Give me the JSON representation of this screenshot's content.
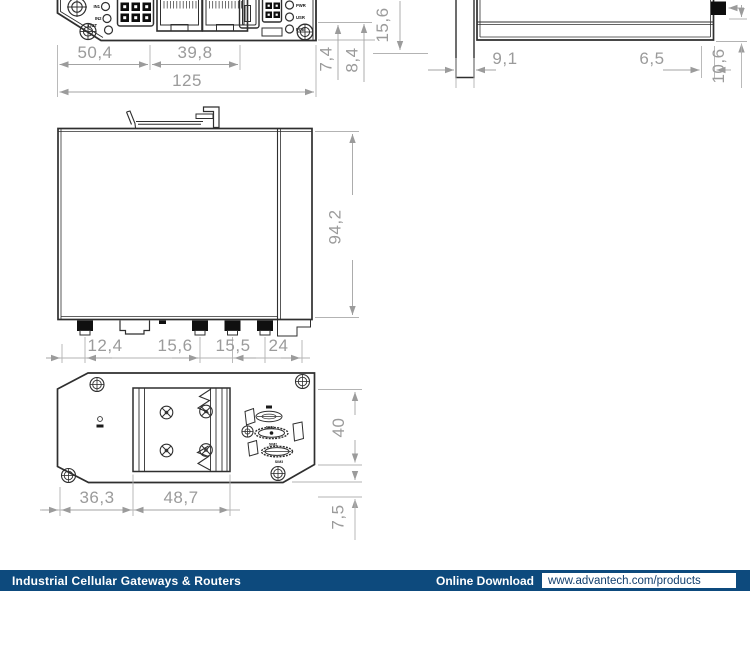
{
  "colors": {
    "navy": "#0d4a7d",
    "drawing_line": "#2f2f2f",
    "dimension_gray": "#9b9b9b"
  },
  "footer": {
    "category": "Industrial Cellular Gateways & Routers",
    "download_label": "Online Download",
    "download_url": "www.advantech.com/products"
  },
  "front_view": {
    "io_led_labels": [
      "IN1",
      "IN2",
      "OUT"
    ],
    "status_led_labels": [
      "PWR",
      "USR",
      "POE"
    ],
    "dim_width_left": "50,4",
    "dim_width_mid": "39,8",
    "dim_width_total": "125",
    "dim_led_offset": "7,4",
    "dim_screw_offset": "8,4"
  },
  "side_view": {
    "dim_height": "15,6",
    "dim_clip": "9,1",
    "dim_conn": "6,5",
    "dim_conn_height": "10,6"
  },
  "top_view": {
    "dim_depth": "94,2",
    "dim_ant1": "12,4",
    "dim_sim": "15,6",
    "dim_ant2": "15,5",
    "dim_ant3": "24"
  },
  "bottom_view": {
    "dim_left": "36,3",
    "dim_plate": "48,7",
    "dim_height": "40",
    "dim_offset": "7,5",
    "sim_cover_labels": [
      "SIM1",
      "SIM2",
      "SIM3"
    ]
  }
}
